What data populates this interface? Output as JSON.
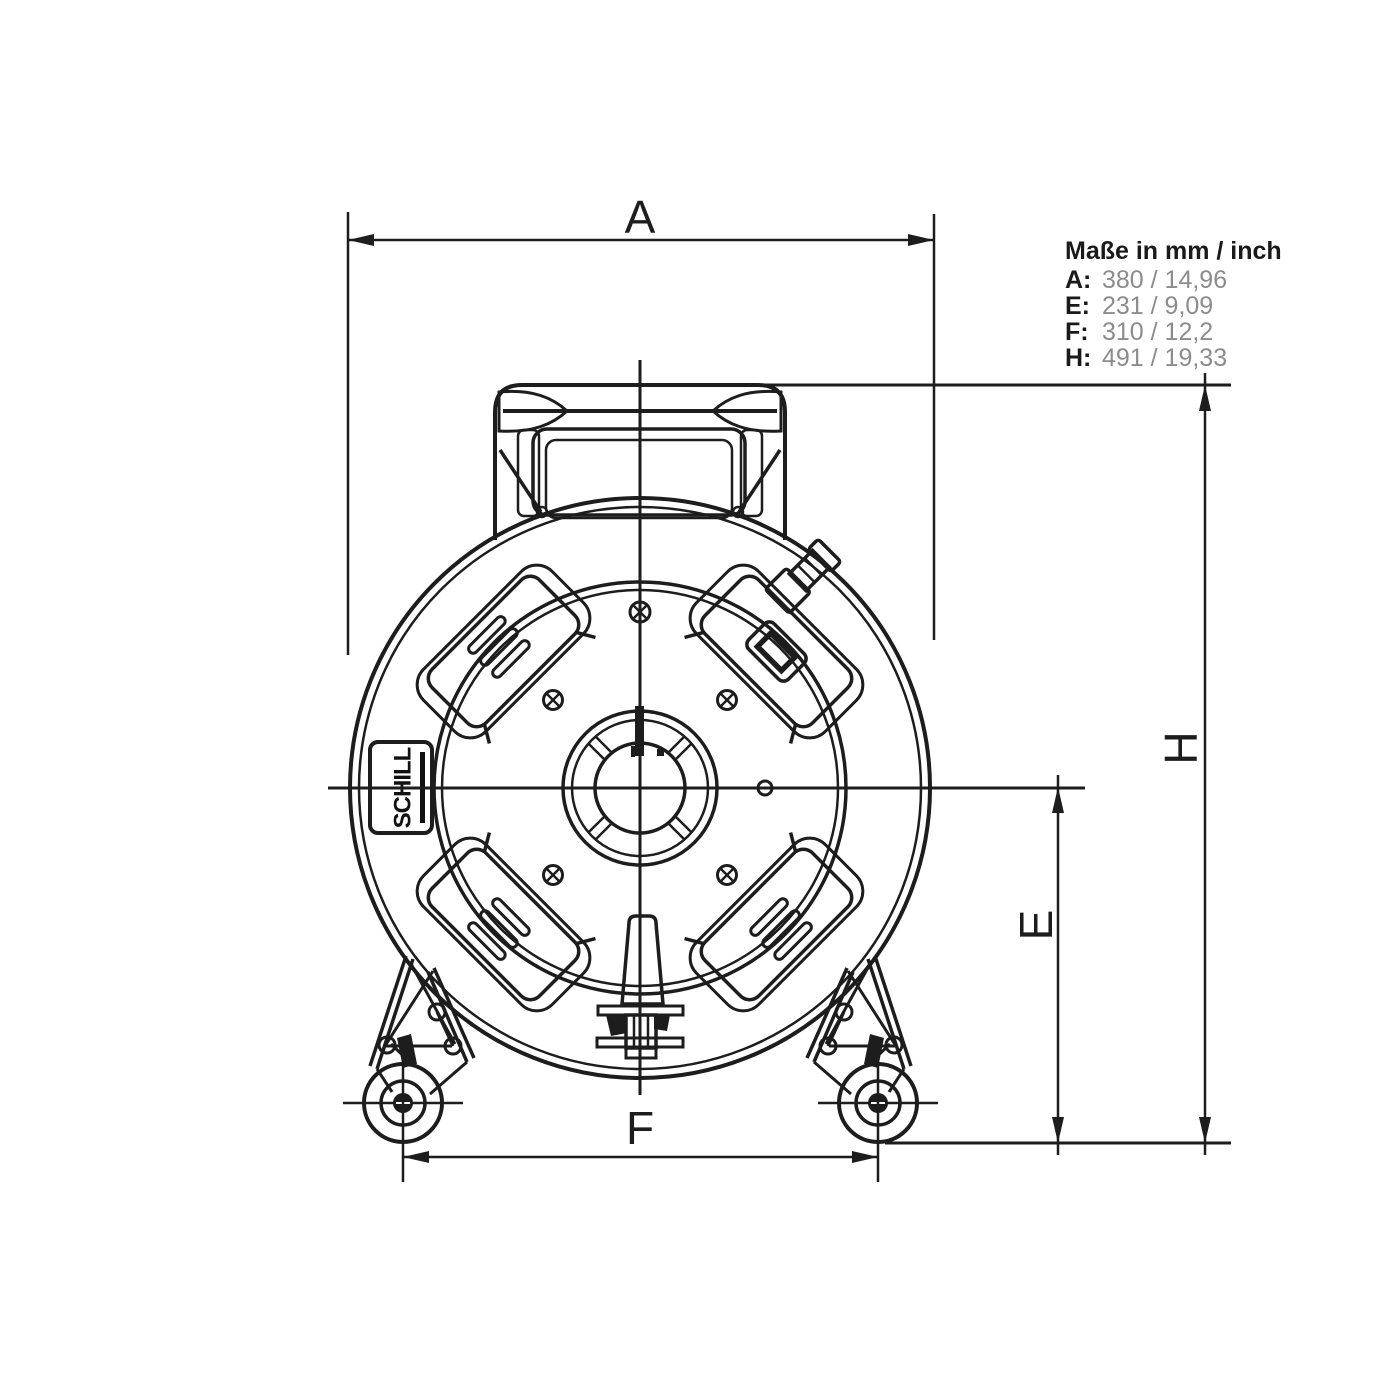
{
  "legend": {
    "title": "Maße in mm / inch",
    "rows": [
      {
        "label": "A:",
        "value": "380 / 14,96"
      },
      {
        "label": "E:",
        "value": "231 / 9,09"
      },
      {
        "label": "F:",
        "value": "310 / 12,2"
      },
      {
        "label": "H:",
        "value": "491 / 19,33"
      }
    ]
  },
  "dimensions": {
    "width_label": "A",
    "height_label": "H",
    "axle_height_label": "E",
    "wheelbase_label": "F"
  },
  "logo": {
    "text": "SCHILL"
  },
  "colors": {
    "line": "#1d1d1d",
    "value_gray": "#8c8c8c",
    "background": "#ffffff"
  }
}
